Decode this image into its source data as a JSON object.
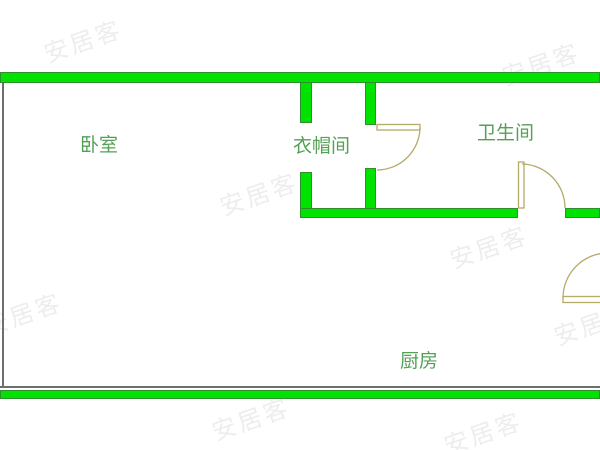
{
  "floorplan": {
    "rooms": [
      {
        "key": "bedroom",
        "label": "卧室"
      },
      {
        "key": "cloakroom",
        "label": "衣帽间"
      },
      {
        "key": "bathroom",
        "label": "卫生间"
      },
      {
        "key": "kitchen",
        "label": "厨房"
      }
    ],
    "watermark_text": "安居客",
    "colors": {
      "wall_fill": "#00e300",
      "wall_edge": "#2e8f2e",
      "boundary_line": "#6e6e6e",
      "door_line": "#b3ab66",
      "label_text": "#54a156",
      "watermark": "#bfbfbf"
    }
  }
}
